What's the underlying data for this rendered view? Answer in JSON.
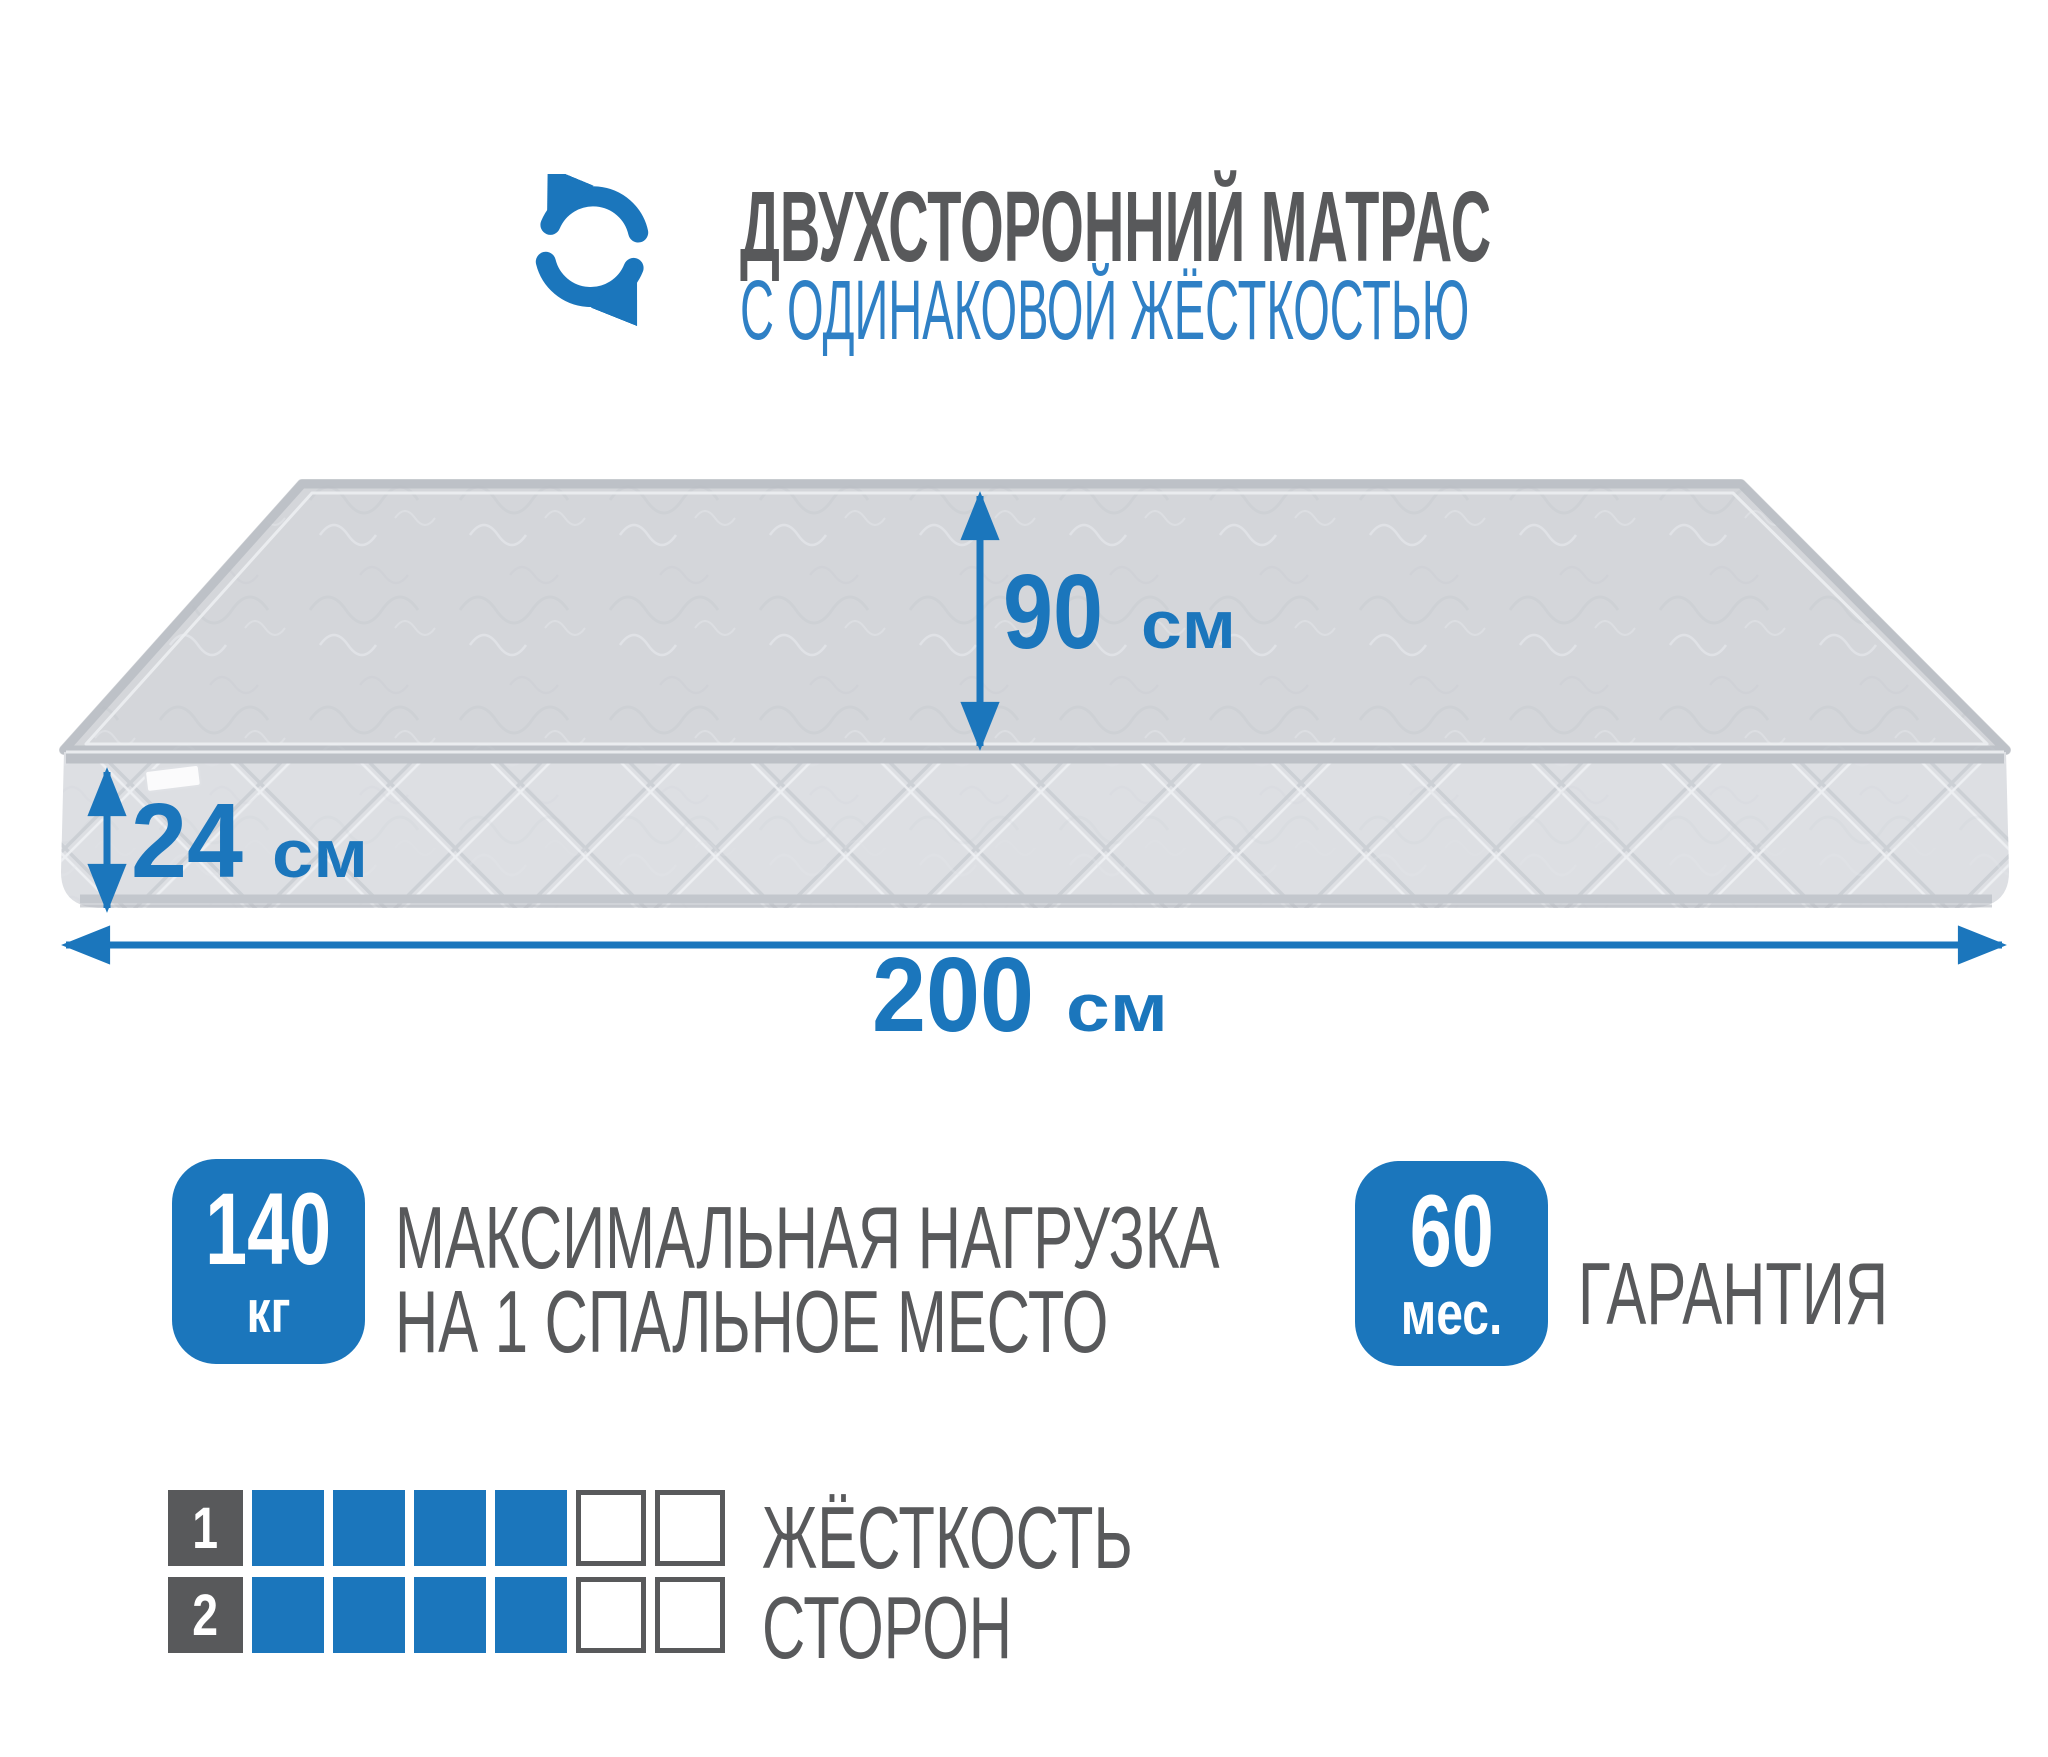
{
  "header": {
    "title": "ДВУХСТОРОННИЙ МАТРАС",
    "subtitle": "С ОДИНАКОВОЙ ЖЁСТКОСТЬЮ",
    "icon": "rotate-arrows-icon"
  },
  "colors": {
    "blue": "#1b76bc",
    "subtitle_blue": "#2f80c5",
    "text_gray": "#58595b",
    "mattress_top": "#d4d6da",
    "mattress_front": "#dddfe3",
    "piping": "#b9bdc3"
  },
  "mattress": {
    "width": {
      "value": "90",
      "unit": "см"
    },
    "thickness": {
      "value": "24",
      "unit": "см"
    },
    "length": {
      "value": "200",
      "unit": "см"
    }
  },
  "badges": {
    "max_load": {
      "value": "140",
      "unit": "кг",
      "label_line1": "МАКСИМАЛЬНАЯ НАГРУЗКА",
      "label_line2": "НА 1 СПАЛЬНОЕ МЕСТО"
    },
    "warranty": {
      "value": "60",
      "unit": "мес.",
      "label": "ГАРАНТИЯ"
    }
  },
  "firmness": {
    "label_line1": "ЖЁСТКОСТЬ",
    "label_line2": "СТОРОН",
    "rows": [
      {
        "index": "1",
        "filled": 4,
        "total": 6
      },
      {
        "index": "2",
        "filled": 4,
        "total": 6
      }
    ]
  }
}
